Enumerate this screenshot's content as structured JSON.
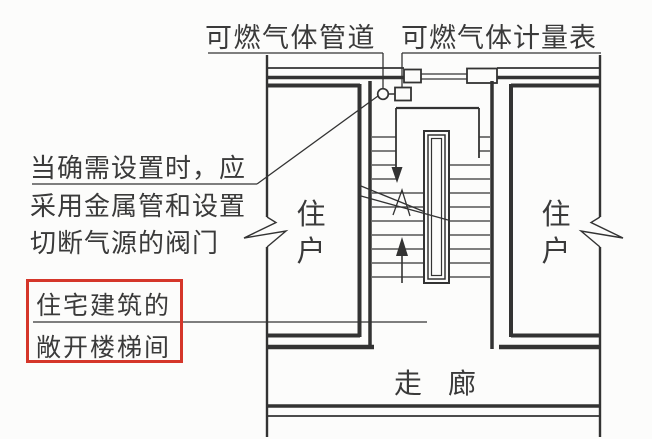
{
  "figure": {
    "type": "architectural-floor-plan",
    "description": "Plan of an open staircase in a residential building with combustible gas pipe and meter",
    "labels": {
      "gas_pipe": "可燃气体管道",
      "gas_meter": "可燃气体计量表",
      "note_line1": "当确需设置时，应",
      "note_line2": "采用金属管和设置",
      "note_line3": "切断气源的阀门",
      "highlight_line1": "住宅建筑的",
      "highlight_line2": "敞开楼梯间",
      "unit_left": "住户",
      "unit_right": "住户",
      "corridor": "走廊"
    },
    "colors": {
      "highlight_box": "#d5362a",
      "linework": "#333333",
      "paper": "#fcfcfb"
    }
  }
}
